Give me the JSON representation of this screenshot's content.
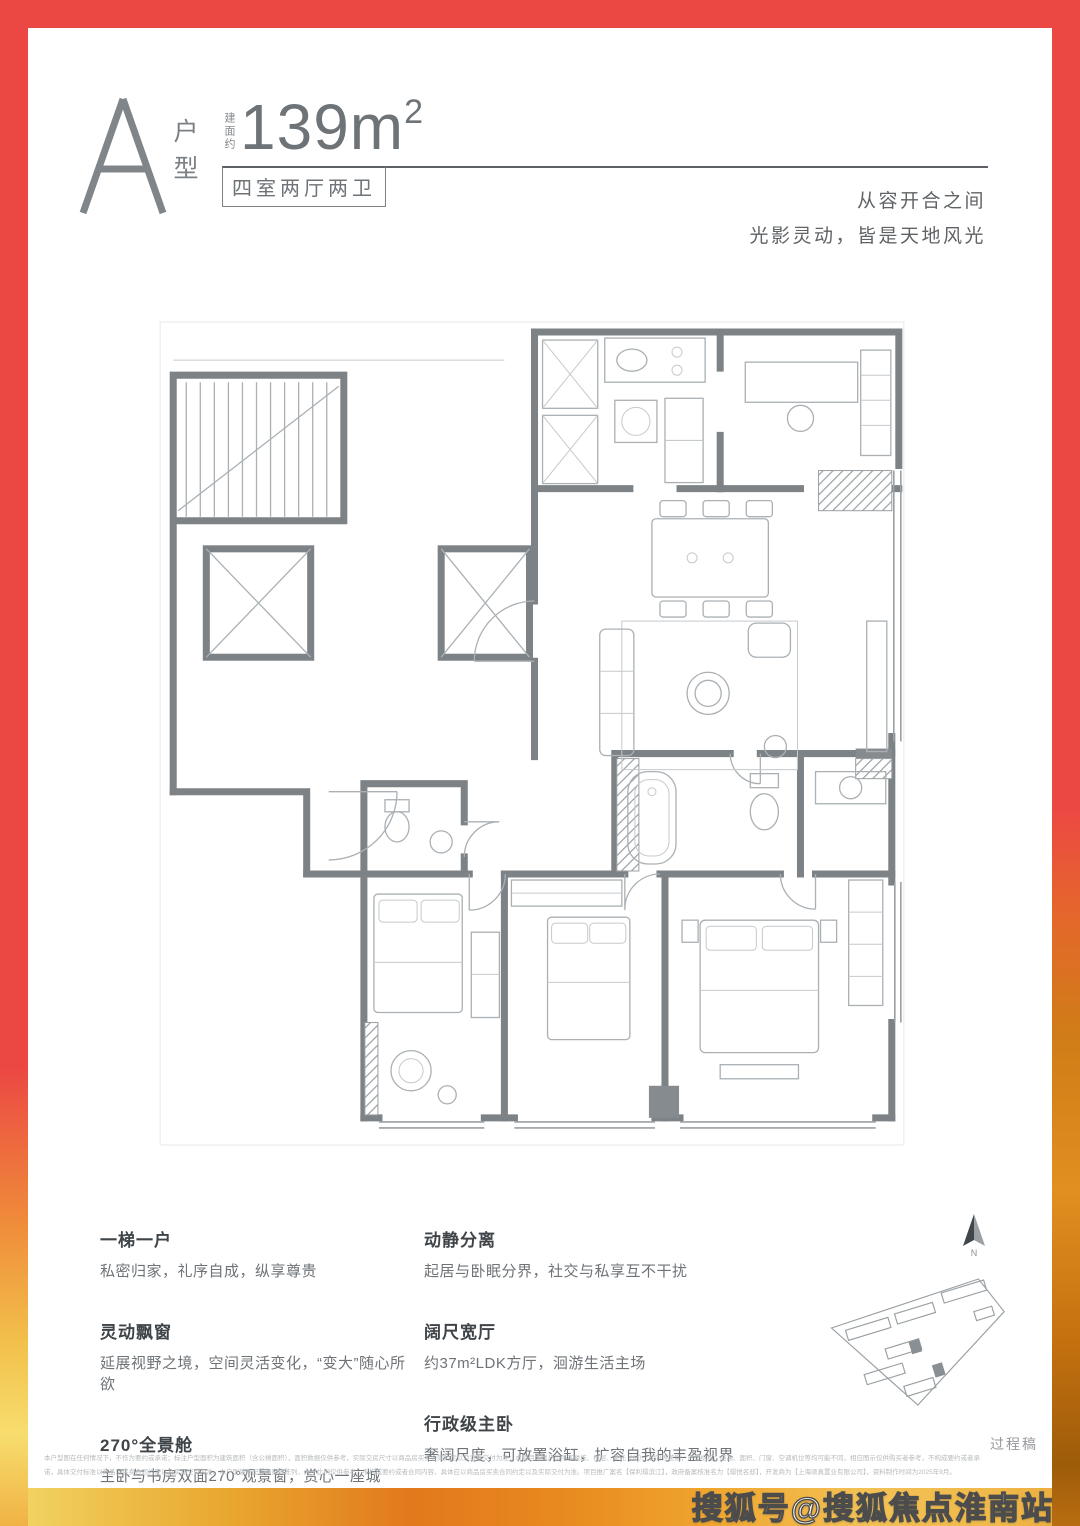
{
  "colors": {
    "frame_red": "#ec4843",
    "frame_orange": "#e2791c",
    "frame_yellow": "#f2d96a",
    "wall_gray": "#7d8286",
    "text_gray": "#6e7377"
  },
  "header": {
    "unit_letter": "A",
    "unit_type_vertical": "户型",
    "area_prefix_vertical": "建面约",
    "area_value": "139m",
    "area_superscript": "2",
    "layout_box_label": "四室两厅两卫",
    "tagline_line1": "从容开合之间",
    "tagline_line2": "光影灵动，皆是天地风光"
  },
  "features": {
    "left": [
      {
        "title": "一梯一户",
        "desc": "私密归家，礼序自成，纵享尊贵"
      },
      {
        "title": "灵动飘窗",
        "desc": "延展视野之境，空间灵活变化，“变大”随心所欲"
      },
      {
        "title": "270°全景舱",
        "desc": "主卧与书房双面270°观景窗，赏心一座城"
      }
    ],
    "right": [
      {
        "title": "动静分离",
        "desc": "起居与卧眠分界，社交与私享互不干扰"
      },
      {
        "title": "阔尺宽厅",
        "desc": "约37m²LDK方厅，洄游生活主场"
      },
      {
        "title": "行政级主卧",
        "desc": "奢阔尺度，可放置浴缸，扩容自我的丰盈视界"
      }
    ]
  },
  "site_plan": {
    "north_label": "N",
    "draft_label": "过程稿"
  },
  "disclaimer": {
    "line1": "本户型图在任何情况下，不作为要约或承诺；标注户型面积为建筑面积（含公摊面积），面积数据仅供参考，实际交房尺寸以商品房买卖合同约定以及实际交付为准；本项目所属户型所在楼栋、楼层、单元（位）、朝向等差别，户型结构、层高、面积、门窗、空调机位等均可能不同，相应图示仅供购买者参考，不构成要约或者承",
    "line2": "诺，具体交付标准以商品房买卖合同约定以及实际交付为准。本户型装修配置和家具陈列，大小比例仅供参考，不构成要约或者合同内容，具体应以商品房买卖合同约定以及实际交付为准。项目推广案名【保利璟滨江】，政府备案核准名为【璟悦名邸】，开发商为【上海颂真置业有限公司】，资料制作时间为2025年9月。"
  },
  "watermark": "搜狐号@搜狐焦点淮南站"
}
